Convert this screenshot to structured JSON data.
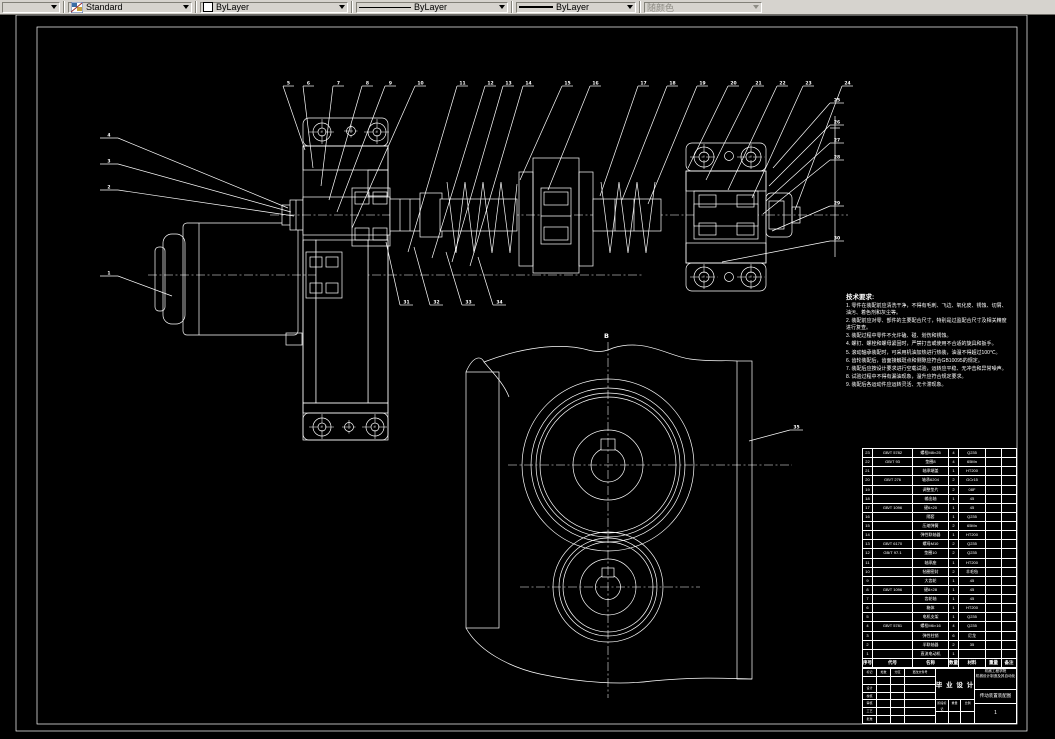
{
  "toolbar": {
    "style": {
      "value": "Standard"
    },
    "color": {
      "value": "ByLayer",
      "swatch_color": "#ffffff"
    },
    "linetype": {
      "value": "ByLayer"
    },
    "lineweight": {
      "value": "ByLayer"
    },
    "plotstyle": {
      "value": "随颜色",
      "disabled": true
    }
  },
  "canvas": {
    "colors": {
      "background": "#000000",
      "line": "#ffffff",
      "toolbar_bg": "#d6d3ce"
    },
    "sheet": {
      "view_b_label": "B"
    },
    "balloons": [
      {
        "l": "4",
        "x": 118,
        "y": 138,
        "ux": -18,
        "tx": 288,
        "ty": 208
      },
      {
        "l": "3",
        "x": 118,
        "y": 164,
        "ux": -18,
        "tx": 291,
        "ty": 212
      },
      {
        "l": "2",
        "x": 118,
        "y": 190,
        "ux": -18,
        "tx": 294,
        "ty": 216
      },
      {
        "l": "1",
        "x": 118,
        "y": 276,
        "ux": -18,
        "tx": 172,
        "ty": 296
      },
      {
        "l": "5",
        "x": 283,
        "y": 86,
        "ux": 11,
        "tx": 305,
        "ty": 150
      },
      {
        "l": "6",
        "x": 303,
        "y": 86,
        "ux": 11,
        "tx": 313,
        "ty": 168
      },
      {
        "l": "7",
        "x": 333,
        "y": 86,
        "ux": 11,
        "tx": 321,
        "ty": 186
      },
      {
        "l": "8",
        "x": 362,
        "y": 86,
        "ux": 11,
        "tx": 329,
        "ty": 200
      },
      {
        "l": "9",
        "x": 385,
        "y": 86,
        "ux": 11,
        "tx": 337,
        "ty": 212
      },
      {
        "l": "10",
        "x": 415,
        "y": 86,
        "ux": 11,
        "tx": 352,
        "ty": 228
      },
      {
        "l": "11",
        "x": 457,
        "y": 86,
        "ux": 11,
        "tx": 408,
        "ty": 252
      },
      {
        "l": "12",
        "x": 485,
        "y": 86,
        "ux": 11,
        "tx": 432,
        "ty": 258
      },
      {
        "l": "13",
        "x": 503,
        "y": 86,
        "ux": 11,
        "tx": 452,
        "ty": 262
      },
      {
        "l": "14",
        "x": 523,
        "y": 86,
        "ux": 11,
        "tx": 470,
        "ty": 266
      },
      {
        "l": "15",
        "x": 562,
        "y": 86,
        "ux": 11,
        "tx": 520,
        "ty": 180
      },
      {
        "l": "16",
        "x": 590,
        "y": 86,
        "ux": 11,
        "tx": 548,
        "ty": 190
      },
      {
        "l": "17",
        "x": 638,
        "y": 86,
        "ux": 11,
        "tx": 600,
        "ty": 196
      },
      {
        "l": "18",
        "x": 667,
        "y": 86,
        "ux": 11,
        "tx": 622,
        "ty": 200
      },
      {
        "l": "19",
        "x": 697,
        "y": 86,
        "ux": 11,
        "tx": 648,
        "ty": 204
      },
      {
        "l": "20",
        "x": 728,
        "y": 86,
        "ux": 11,
        "tx": 688,
        "ty": 168
      },
      {
        "l": "21",
        "x": 753,
        "y": 86,
        "ux": 11,
        "tx": 706,
        "ty": 180
      },
      {
        "l": "22",
        "x": 777,
        "y": 86,
        "ux": 11,
        "tx": 728,
        "ty": 190
      },
      {
        "l": "23",
        "x": 803,
        "y": 86,
        "ux": 11,
        "tx": 752,
        "ty": 198
      },
      {
        "l": "24",
        "x": 842,
        "y": 86,
        "ux": 11,
        "tx": 795,
        "ty": 210
      },
      {
        "l": "25",
        "x": 830,
        "y": 103,
        "ux": 14,
        "tx": 773,
        "ty": 168
      },
      {
        "l": "26",
        "x": 830,
        "y": 125,
        "ux": 14,
        "tx": 769,
        "ty": 186
      },
      {
        "l": "27",
        "x": 830,
        "y": 143,
        "ux": 14,
        "tx": 766,
        "ty": 201
      },
      {
        "l": "28",
        "x": 830,
        "y": 160,
        "ux": 14,
        "tx": 763,
        "ty": 214
      },
      {
        "l": "29",
        "x": 830,
        "y": 206,
        "ux": 14,
        "tx": 772,
        "ty": 231
      },
      {
        "l": "30",
        "x": 830,
        "y": 241,
        "ux": 14,
        "tx": 722,
        "ty": 262
      },
      {
        "l": "31",
        "x": 400,
        "y": 305,
        "ux": 13,
        "tx": 386,
        "ty": 242
      },
      {
        "l": "32",
        "x": 430,
        "y": 305,
        "ux": 13,
        "tx": 414,
        "ty": 247
      },
      {
        "l": "33",
        "x": 462,
        "y": 305,
        "ux": 13,
        "tx": 446,
        "ty": 252
      },
      {
        "l": "34",
        "x": 493,
        "y": 305,
        "ux": 13,
        "tx": 478,
        "ty": 257
      },
      {
        "l": "35",
        "x": 790,
        "y": 430,
        "ux": 13,
        "tx": 749,
        "ty": 441
      }
    ],
    "tech_requirements": {
      "title": "技术要求:",
      "items": [
        "1. 零件在装配前应清洗干净，不得有毛刺、飞边、氧化皮、锈蚀、切屑、油污、着色剂和灰尘等。",
        "2. 装配前应对零、部件的主要配合尺寸，特别是过盈配合尺寸及相关精度进行复查。",
        "3. 装配过程中零件不允许磕、碰、划伤和锈蚀。",
        "4. 螺钉、螺栓和螺母紧固时，严禁打击或使用不合适的旋具和扳手。",
        "5. 滚动轴承装配时，可采用机油加热进行热装，油温不得超过100℃。",
        "6. 齿轮装配后，齿面接触斑点和侧隙应符合GB10095的规定。",
        "7. 装配后应按设计要求进行空载试验，运转应平稳、无冲击和异常噪声。",
        "8. 试验过程中不得有漏油现象，温升应符合规定要求。",
        "9. 装配后各运动件应运转灵活、无卡滞现象。"
      ]
    },
    "parts_list": {
      "headers": [
        "序号",
        "代号",
        "名称",
        "数量",
        "材料",
        "重量",
        "备注"
      ],
      "rows": [
        [
          "23",
          "GB/T 5782",
          "螺栓M8×25",
          "4",
          "Q235",
          "",
          ""
        ],
        [
          "22",
          "GB/T 93",
          "垫圈8",
          "4",
          "65Mn",
          "",
          ""
        ],
        [
          "21",
          "",
          "轴承端盖",
          "1",
          "HT200",
          "",
          ""
        ],
        [
          "20",
          "GB/T 276",
          "轴承6204",
          "2",
          "GCr15",
          "",
          ""
        ],
        [
          "19",
          "",
          "调整垫片",
          "2",
          "08F",
          "",
          ""
        ],
        [
          "18",
          "",
          "输出轴",
          "1",
          "45",
          "",
          ""
        ],
        [
          "17",
          "GB/T 1096",
          "键6×20",
          "1",
          "45",
          "",
          ""
        ],
        [
          "16",
          "",
          "隔套",
          "1",
          "Q235",
          "",
          ""
        ],
        [
          "15",
          "",
          "压缩弹簧",
          "2",
          "65Mn",
          "",
          ""
        ],
        [
          "14",
          "",
          "弹性联轴器",
          "1",
          "HT200",
          "",
          ""
        ],
        [
          "13",
          "GB/T 6170",
          "螺母M10",
          "2",
          "Q235",
          "",
          ""
        ],
        [
          "12",
          "GB/T 97.1",
          "垫圈10",
          "2",
          "Q235",
          "",
          ""
        ],
        [
          "11",
          "",
          "轴承座",
          "1",
          "HT200",
          "",
          ""
        ],
        [
          "10",
          "",
          "毡圈密封",
          "2",
          "羊毛毡",
          "",
          ""
        ],
        [
          "9",
          "",
          "大齿轮",
          "1",
          "45",
          "",
          ""
        ],
        [
          "8",
          "GB/T 1096",
          "键8×28",
          "1",
          "45",
          "",
          ""
        ],
        [
          "7",
          "",
          "齿轮轴",
          "1",
          "45",
          "",
          ""
        ],
        [
          "6",
          "",
          "箱体",
          "1",
          "HT200",
          "",
          ""
        ],
        [
          "5",
          "",
          "电机支架",
          "1",
          "Q235",
          "",
          ""
        ],
        [
          "4",
          "GB/T 5781",
          "螺栓M6×16",
          "4",
          "Q235",
          "",
          ""
        ],
        [
          "3",
          "",
          "弹性柱销",
          "6",
          "尼龙",
          "",
          ""
        ],
        [
          "2",
          "",
          "半联轴器",
          "2",
          "35",
          "",
          ""
        ],
        [
          "1",
          "",
          "直流电动机",
          "1",
          "",
          "",
          ""
        ]
      ]
    },
    "title_block": {
      "project_label": "毕 业 设 计",
      "org_line1": "机械工程学院",
      "org_line2": "机械设计制造及其自动化",
      "drawing_title": "传动装置装配图",
      "drawing_no": "1",
      "left_cells": [
        [
          "标记",
          "处数",
          "分区",
          "更改文件号"
        ],
        [
          "",
          "",
          "",
          ""
        ],
        [
          "设计",
          "",
          "",
          ""
        ],
        [
          "校核",
          "",
          "",
          ""
        ],
        [
          "审核",
          "",
          "",
          ""
        ],
        [
          "工艺",
          "",
          "",
          ""
        ],
        [
          "批准",
          "",
          "",
          ""
        ]
      ],
      "mid_cells": [
        [
          "阶段标记",
          "重量",
          "比例"
        ],
        [
          "",
          "",
          ""
        ]
      ]
    }
  }
}
